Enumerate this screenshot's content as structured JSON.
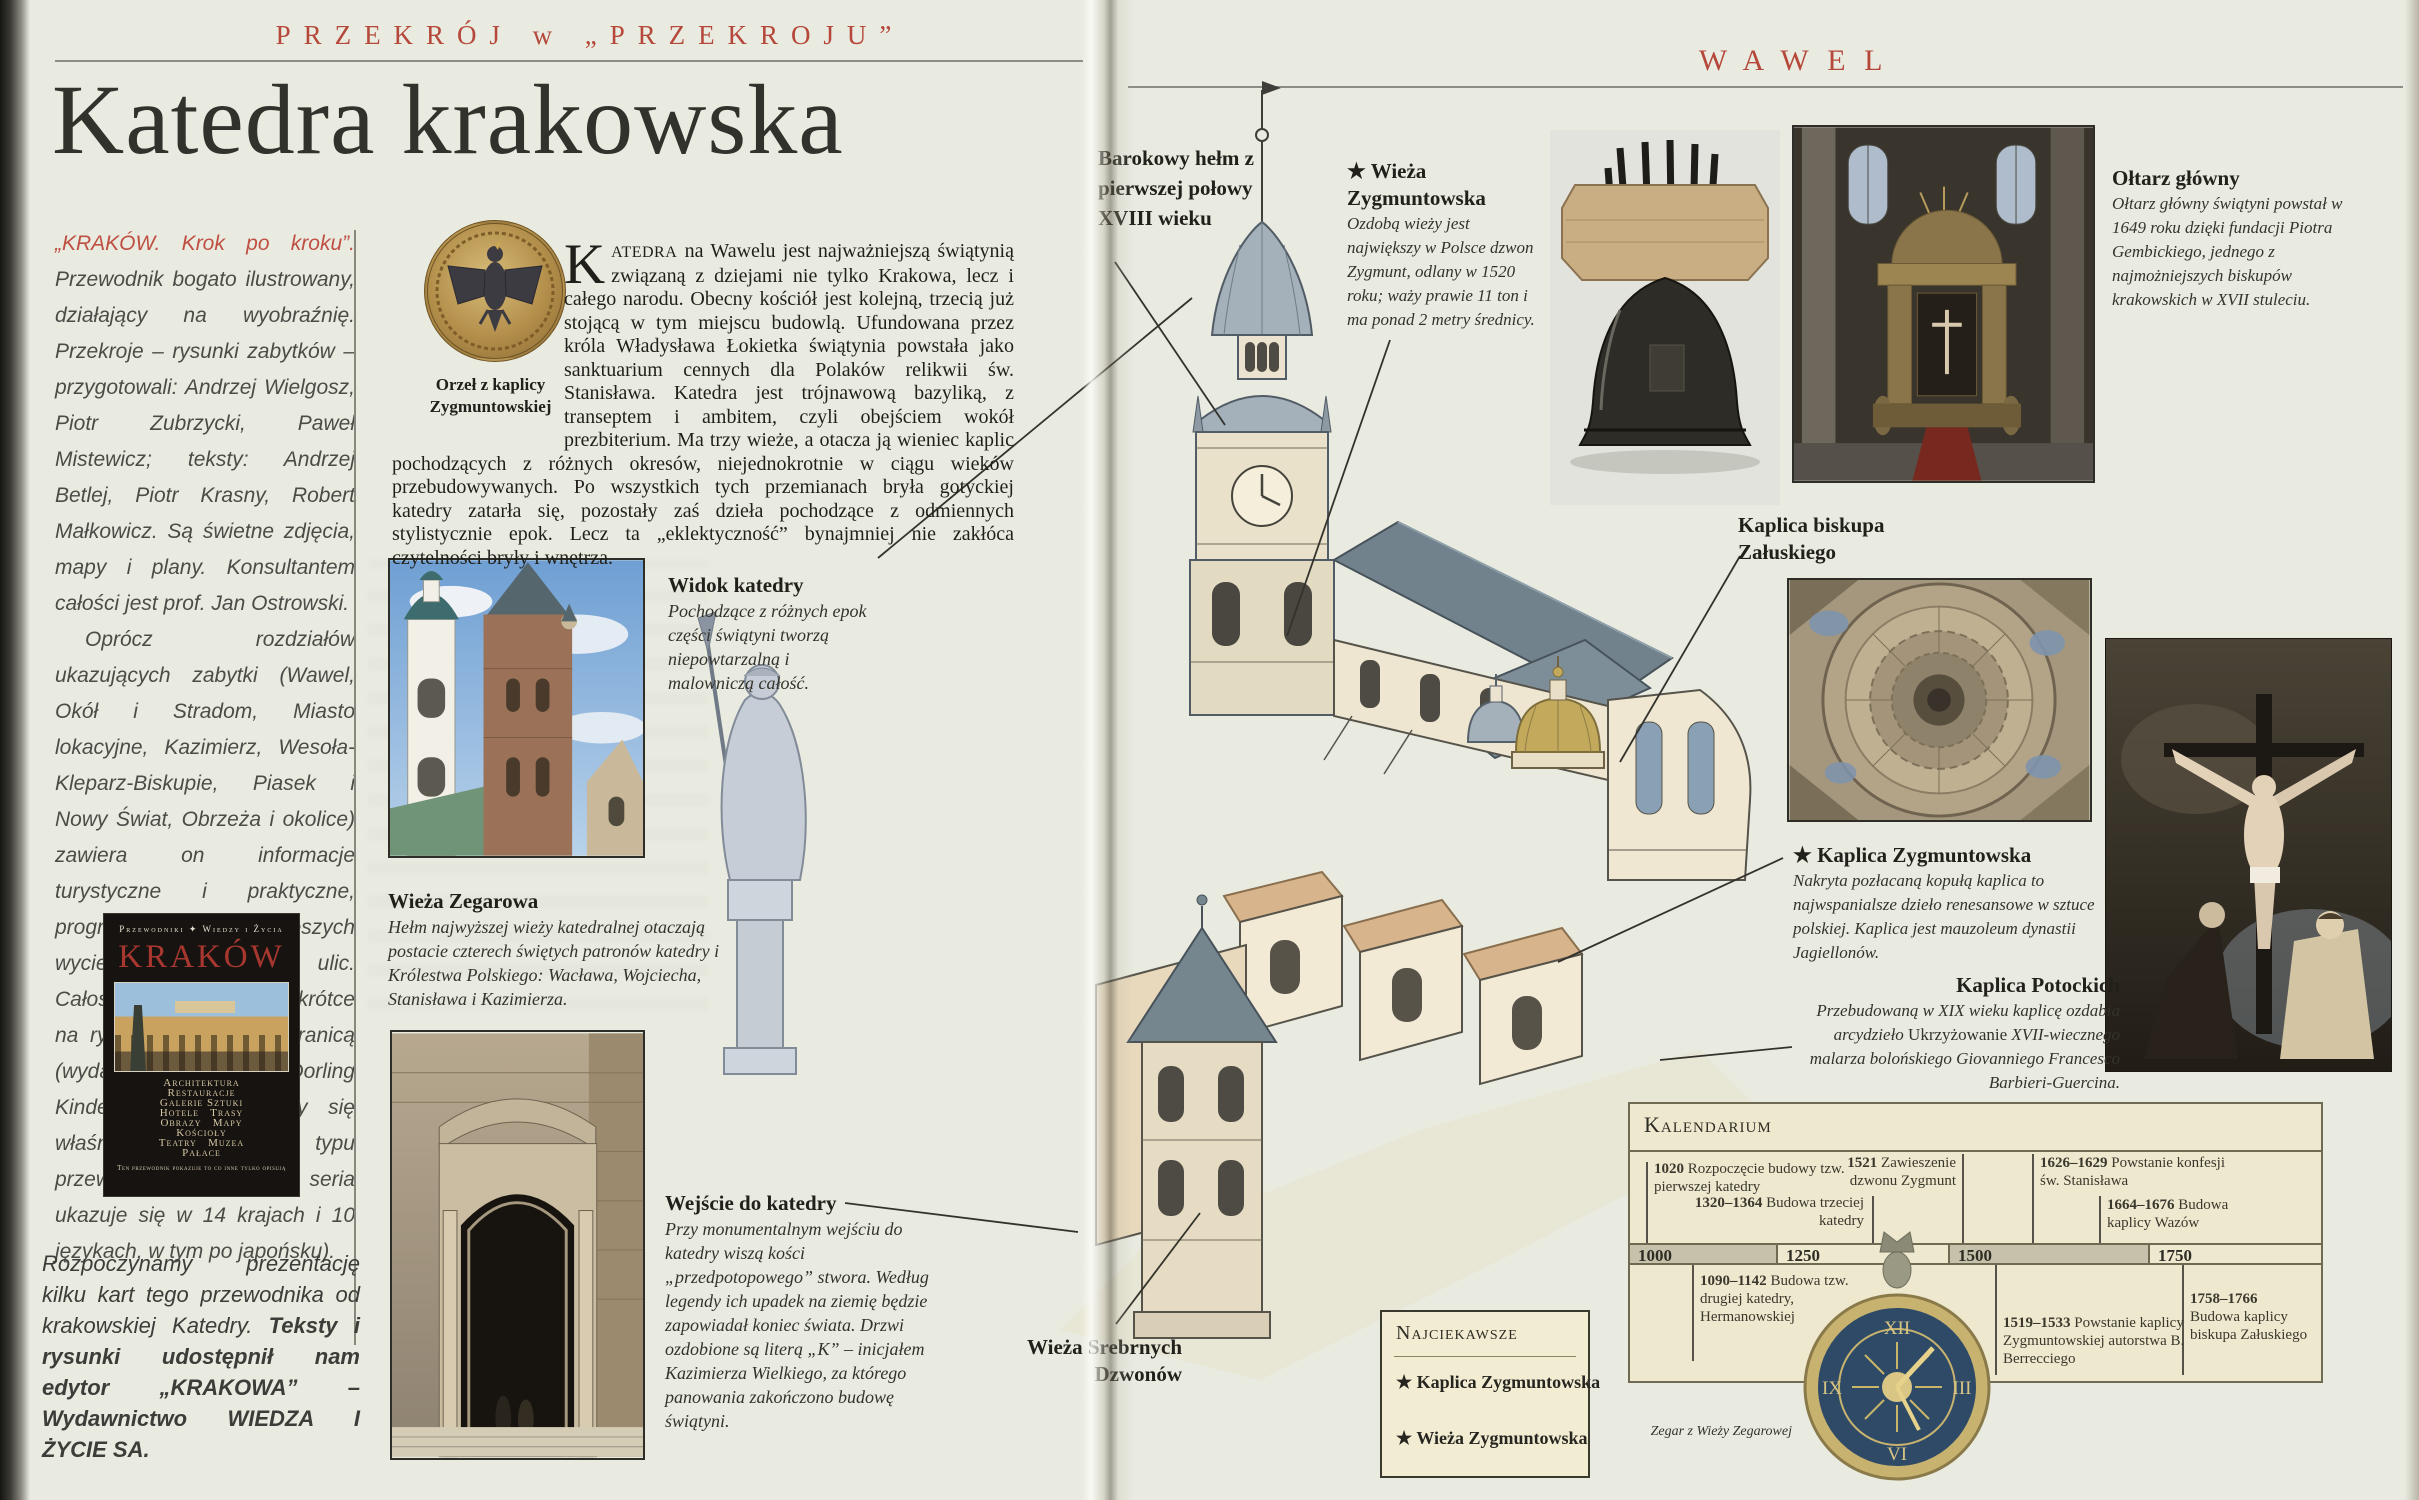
{
  "colors": {
    "accent_red": "#b5483a",
    "paper": "#e9ebe1",
    "cream_box": "#eee8cf",
    "box_border": "#6f6a52",
    "najciekawsze_bg": "#f2ecd2",
    "timeline_gray": "#c6c1ab",
    "text_dark": "#26251f"
  },
  "icons": {
    "star": "★",
    "publisher": "✦"
  },
  "left": {
    "kicker": "PRZEKRÓJ w „PRZEKROJU”",
    "title": "Katedra krakowska",
    "sidebar": {
      "lead": "„KRAKÓW. Krok po kroku”.",
      "para1": "Przewodnik bogato ilustrowany, działający na wyobraźnię. Przekroje – rysunki zabytków – przygotowali: Andrzej Wielgosz, Piotr Zubrzycki, Paweł Mistewicz; teksty: Andrzej Betlej, Piotr Krasny, Robert Małkowicz. Są świetne zdjęcia, mapy i plany. Konsultantem całości jest prof. Jan Ostrowski.",
      "para2": "Oprócz rozdziałów ukazujących zabytki (Wawel, Okół i Stradom, Miasto lokacyjne, Kazimierz, Wesoła-Kleparz-Biskupie, Piasek i Nowy Świat, Obrzeża i okolice) zawiera on informacje turystyczne i praktyczne, program trzech pieszych wycieczek, plany, spisy ulic. Całość liczy 256 stron. Wkrótce na rynku polskim i za granicą (wydaje brytyjski edytor Dorling Kindersley, specjalizujący się właśnie w tego typu przewodnikach. Ta seria ukazuje się w 14 krajach i 10 językach, w tym po japońsku).",
      "footer_normal": "Rozpoczynamy prezentację kilku kart tego przewodnika od krakowskiej Katedry. ",
      "footer_bold": "Teksty i rysunki udostępnił nam edytor „KRAKOWA” – Wydawnictwo WIEDZA I ŻYCIE SA."
    },
    "cover": {
      "brand1": "Przewodniki",
      "brand2": "Wiedzy i Życia",
      "title": "KRAKÓW",
      "cats": [
        "Architektura",
        "Restauracje",
        "Galerie Sztuki",
        "Hotele",
        "Trasy",
        "Obrazy",
        "Mapy",
        "Kościoły",
        "Teatry",
        "Muzea",
        "Pałace"
      ],
      "tagline": "Ten przewodnik pokazuje to co inne tylko opisują"
    },
    "intro": {
      "dropcap": "K",
      "smallcaps": "ATEDRA",
      "rest": " na Wawelu jest najważniejszą świątynią związaną z dziejami nie tylko Krakowa, lecz i całego narodu. Obecny kościół jest kolejną, trzecią już stojącą w tym miejscu budowlą. Ufundowana przez króla Władysława Łokietka świątynia powstała jako sanktuarium cennych dla Polaków relikwii św. Stanisława. Katedra jest trójnawową bazyliką, z transeptem i ambitem, czyli obejściem wokół prezbiterium. Ma trzy wieże, a otacza ją wieniec kaplic pochodzących z różnych okresów, niejednokrotnie w ciągu wieków przebudowywanych. Po wszystkich tych przemianach bryła gotyckiej katedry zatarła się, pozostały zaś dzieła pochodzące z odmiennych stylistycznie epok. Lecz ta „eklektyczność” bynajmniej nie zakłóca czytelności bryły i wnętrza."
    },
    "captions": {
      "orzel": "Orzeł z kaplicy Zygmuntowskiej",
      "widok_title": "Widok katedry",
      "widok_body": "Pochodzące z różnych epok części świątyni tworzą niepowtarzalną i malowniczą całość.",
      "zegarowa_title": "Wieża Zegarowa",
      "zegarowa_body": "Hełm najwyższej wieży katedralnej otaczają postacie czterech świętych patronów katedry i Królestwa Polskiego: Wacława, Wojciecha, Stanisława i Kazimierza.",
      "wejscie_title": "Wejście do katedry",
      "wejscie_body": "Przy monumentalnym wejściu do katedry wiszą kości „przedpotopowego” stwora. Według legendy ich upadek na ziemię będzie zapowiadał koniec świata. Drzwi ozdobione są literą „K” – inicjałem Kazimierza Wielkiego, za którego panowania zakończono budowę świątyni.",
      "barokowy": "Barokowy hełm z pierwszej połowy XVIII wieku",
      "srebrnych": "Wieża Srebrnych Dzwonów"
    }
  },
  "right": {
    "kicker": "WAWEL",
    "bell": {
      "title": "Wieża Zygmuntowska",
      "body": "Ozdobą wieży jest największy w Polsce dzwon Zygmunt, odlany w 1520 roku; waży prawie 11 ton i ma ponad 2 metry średnicy."
    },
    "oltarz": {
      "title": "Ołtarz główny",
      "body": "Ołtarz główny świątyni powstał w 1649 roku dzięki fundacji Piotra Gembickiego, jednego z najmożniejszych biskupów krakowskich w XVII stuleciu."
    },
    "zaluskiego": "Kaplica biskupa Załuskiego",
    "zygmuntowska": {
      "title": "Kaplica Zygmuntowska",
      "body": "Nakryta pozłacaną kopułą kaplica to najwspanialsze dzieło renesansowe w sztuce polskiej. Kaplica jest mauzoleum dynastii Jagiellonów."
    },
    "potockich": {
      "title": "Kaplica Potockich",
      "body_pre": "Przebudowaną w XIX wieku kaplicę ozdabia arcydzieło ",
      "body_title": "Ukrzyżowanie",
      "body_post": " XVII-wiecznego malarza bolońskiego Giovanniego Francesco Barbieri-Guercina."
    },
    "zegar": "Zegar z Wieży Zegarowej",
    "clock_numerals": [
      "XII",
      "III",
      "VI",
      "IX"
    ],
    "kalendarium": {
      "title": "Kalendarium",
      "above": [
        {
          "y": "1020",
          "t": "Rozpoczęcie budowy tzw. pierwszej katedry"
        },
        {
          "y": "1320–1364",
          "t": "Budowa trzeciej katedry"
        },
        {
          "y": "1521",
          "t": "Zawieszenie dzwonu Zygmunt"
        },
        {
          "y": "1626–1629",
          "t": "Powstanie konfesji św. Stanisława"
        },
        {
          "y": "1664–1676",
          "t": "Budowa kaplicy Wazów"
        }
      ],
      "scale": [
        "1000",
        "1250",
        "1500",
        "1750"
      ],
      "below": [
        {
          "y": "1090–1142",
          "t": "Budowa tzw. drugiej katedry, Hermanowskiej"
        },
        {
          "y": "1519–1533",
          "t": "Powstanie kaplicy Zygmuntowskiej autorstwa B. Berrecciego"
        },
        {
          "y": "1758–1766",
          "t": "Budowa kaplicy biskupa Załuskiego"
        }
      ]
    },
    "najciekawsze": {
      "title": "Najciekawsze",
      "items": [
        "Kaplica Zygmuntowska",
        "Wieża Zygmuntowska"
      ]
    }
  }
}
